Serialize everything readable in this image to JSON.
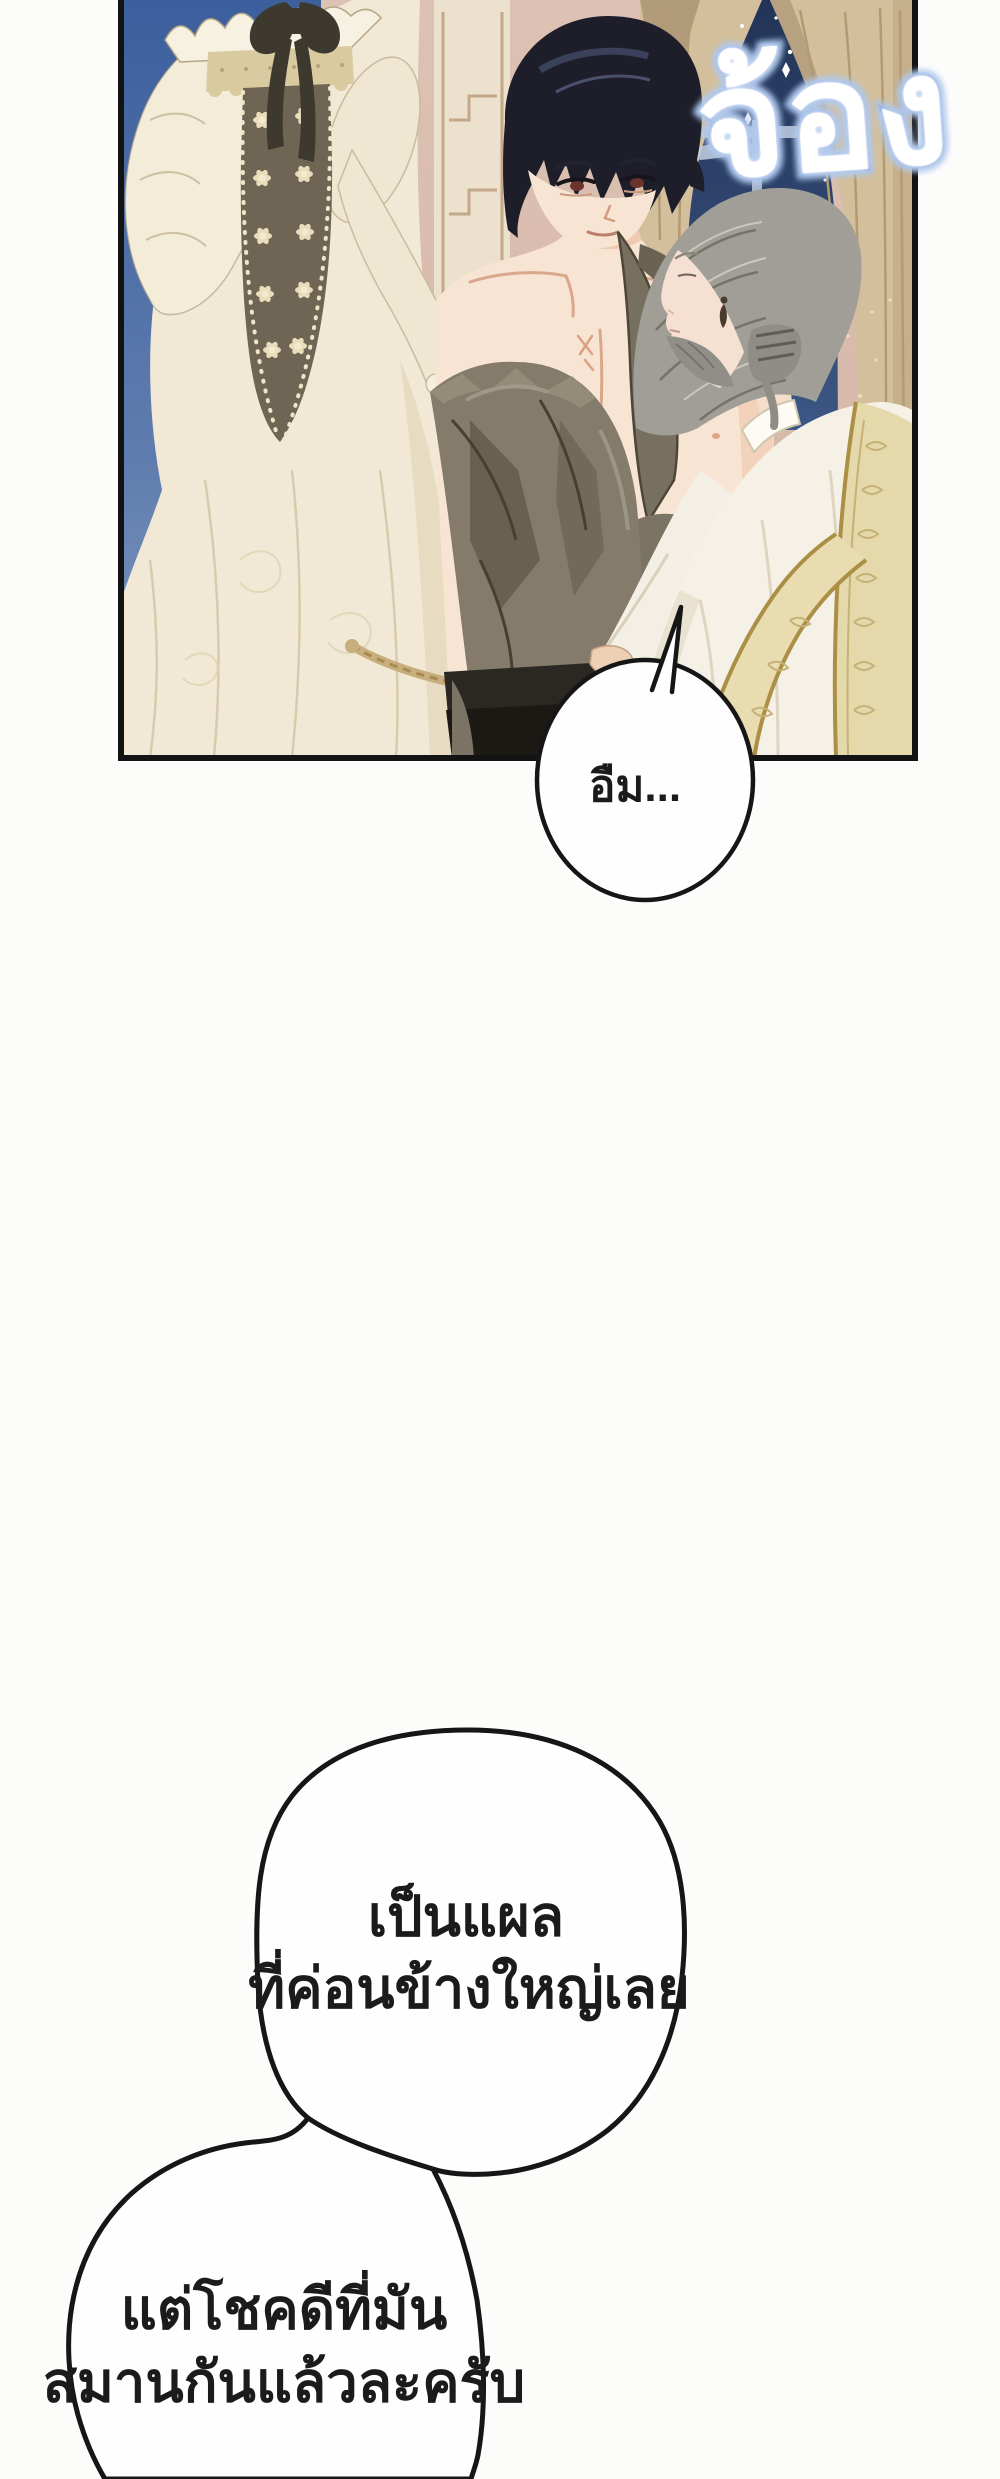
{
  "page": {
    "width": 1000,
    "height": 2479,
    "background": "#fcfcfb"
  },
  "sfx": {
    "text": "จ้อง",
    "fill_color": "#ffffff",
    "glow_color": "#8fade0"
  },
  "bubbles": [
    {
      "id": "bubble-um",
      "text": "อืม..."
    },
    {
      "id": "bubble-wound",
      "line1": "เป็นแผล",
      "line2": "ที่ค่อนข้างใหญ่เลย"
    },
    {
      "id": "bubble-healed",
      "line1": "แต่โชคดีที่มัน",
      "line2": "สมานกันแล้วละครับ"
    }
  ],
  "panel": {
    "border_color": "#131313",
    "colors": {
      "sky_left_top": "#3c5f9d",
      "sky_left_bottom": "#849cc2",
      "wall_pink": "#d9bcae",
      "pilaster_cream": "#ebe1cc",
      "moulding_line": "#c3a88a",
      "night_sky_top": "#223457",
      "night_sky_bottom": "#3c5685",
      "window_frame": "#b6c4da",
      "star": "#ffffff",
      "curtain": "#d3bf9b",
      "curtain_fold": "#b39a71",
      "gown_cream": "#f1e9d5",
      "gown_fold": "#d8cbad",
      "lace_band": "#d9caa0",
      "stomacher_olive": "#6e6555",
      "rosette": "#e9ddbc",
      "bow_dark": "#3e392e",
      "skin": "#f8e4d2",
      "skin_shadow": "#eec6ad",
      "hair_man": "#1e1e2b",
      "hair_sheen": "#3f4560",
      "iris": "#6d342e",
      "coat_grey": "#847b6b",
      "coat_fold_dark": "#645c4d",
      "trousers": "#2b2722",
      "hair_priest": "#a09e97",
      "robe_white": "#f6f1e7",
      "stole_gold": "#e5d8aa",
      "stole_edge": "#ab8f45",
      "bubble_fill": "#fefefe",
      "bubble_stroke": "#161616",
      "text_color": "#1b1b1b"
    }
  }
}
